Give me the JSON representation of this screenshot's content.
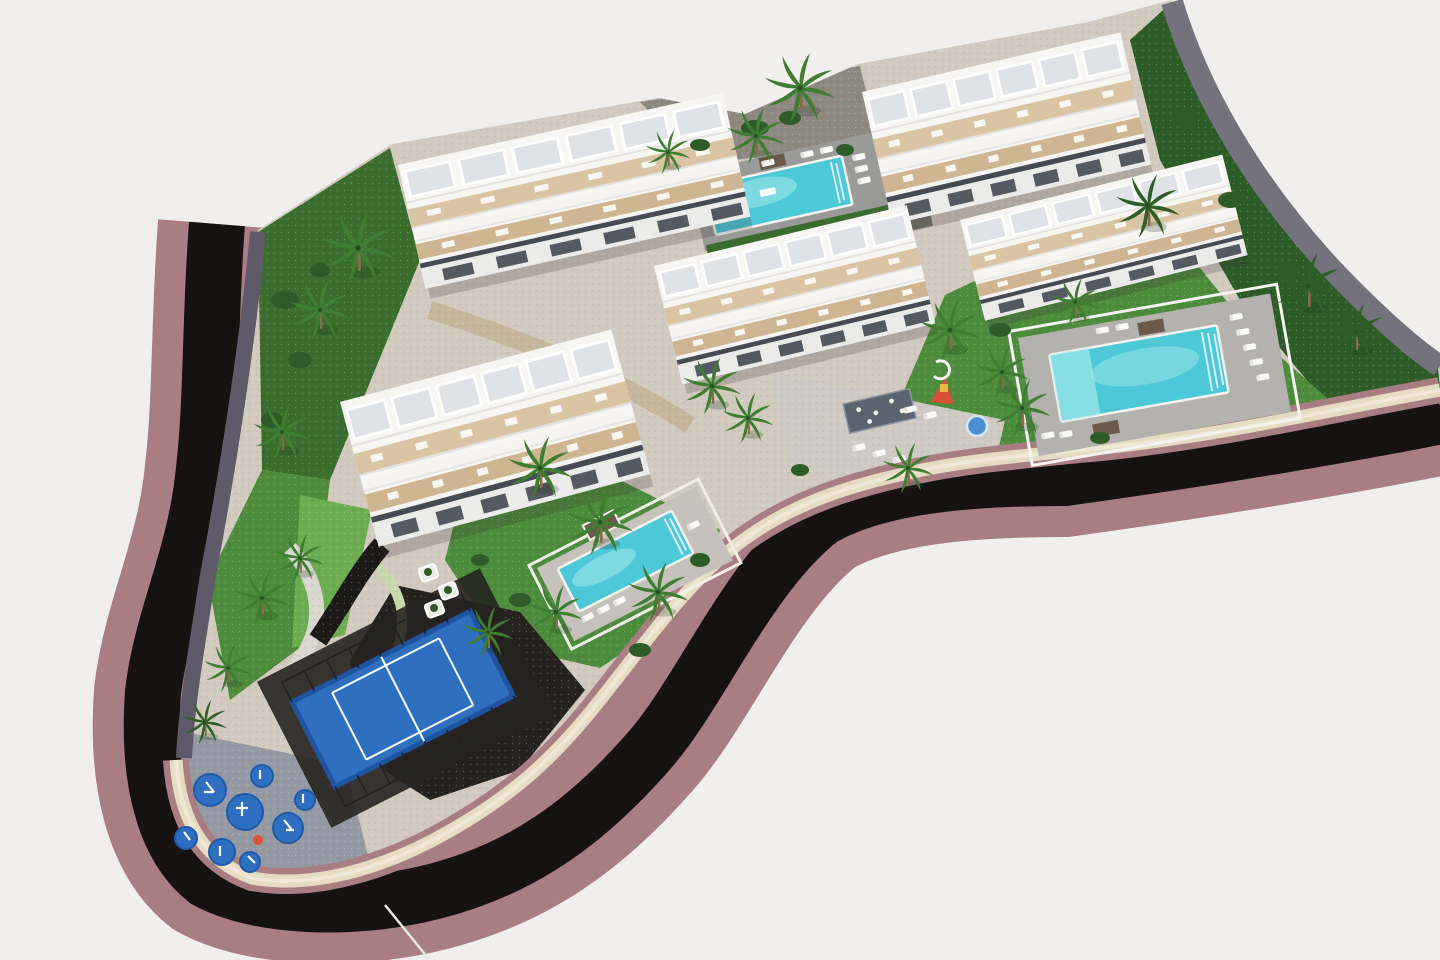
{
  "scene": {
    "title": "Aerial render of coastal apartment complex",
    "type": "3d-architectural-visualization",
    "description": "Bird's-eye view of five white terraced apartment blocks with communal pools, gardens, palm trees, a padel court and a playground, bordered by a curving dark road with a mauve sidewalk."
  },
  "palette": {
    "background": "#f0efee",
    "road": "#161212",
    "sidewalk": "#a87e83",
    "wall_cream": "#e6dcc3",
    "wall_cream_light": "#f0e8d6",
    "wall_slate": "#5e5a6a",
    "wall_gray": "#74737d",
    "site_base": "#d2cabf",
    "paving_dark": "#8d8981",
    "plaza": "#cfcac3",
    "walkway": "#dad7d1",
    "walkway_green": "#c9d7ad",
    "ramp": "#1c1a19",
    "lawn": "#4c8c3c",
    "lawn_bright": "#6cad52",
    "lawn_dark": "#3a6d2e",
    "hillside": "#2d5c29",
    "bush": "#2e5c28",
    "palm": "#3f7d33",
    "palm_dark": "#2d5f26",
    "trunk": "#8a6b4f",
    "pool_water": "#4cc8d6",
    "pool_light": "#a8e9ec",
    "deck_north": "#9a9a98",
    "deck_east": "#b4b2ae",
    "deck_south": "#c6c2bb",
    "hedge": "#3a6b2f",
    "building_white": "#f7f6f3",
    "pergola": "#dfe3e7",
    "terrace": "#d9c4a4",
    "terrace_dark": "#cdb691",
    "glass": "#454a53",
    "front_face": "#ebebe9",
    "court_blue": "#2e6fc0",
    "court_dark": "#26231f",
    "cage": "#232326",
    "play_paving": "#9599a3",
    "play_blue": "#2e6fc1",
    "accent_red": "#d85238",
    "wood": "#6b5a49",
    "white": "#ffffff"
  },
  "objects": {
    "buildings": [
      {
        "id": "building-1",
        "label": "Terraced apartment block - north-west"
      },
      {
        "id": "building-2",
        "label": "Terraced apartment block - north-east"
      },
      {
        "id": "building-3",
        "label": "Terraced apartment block - centre"
      },
      {
        "id": "building-4",
        "label": "Terraced apartment block - east"
      },
      {
        "id": "building-5",
        "label": "Terraced apartment block - south-west"
      }
    ],
    "pools": [
      {
        "id": "pool-north",
        "label": "Lap pool between the north blocks"
      },
      {
        "id": "pool-east",
        "label": "Main community pool on the east lawn"
      },
      {
        "id": "pool-south",
        "label": "Garden pool by the south-west block"
      }
    ],
    "amenities": [
      {
        "id": "padel-court",
        "label": "Fenced padel court"
      },
      {
        "id": "playground",
        "label": "Playground with blue safety pads"
      },
      {
        "id": "kids-play-area",
        "label": "Kids play corner with slide"
      },
      {
        "id": "water-feature",
        "label": "Plaza water feature"
      }
    ],
    "landscape": [
      {
        "id": "perimeter-road",
        "label": "Curving asphalt road"
      },
      {
        "id": "sidewalk",
        "label": "Mauve perimeter sidewalk"
      },
      {
        "id": "boundary-walls",
        "label": "Stone boundary walls"
      },
      {
        "id": "palm-trees",
        "label": "Palm trees"
      },
      {
        "id": "lawns",
        "label": "Lawns and planted gardens"
      }
    ]
  }
}
